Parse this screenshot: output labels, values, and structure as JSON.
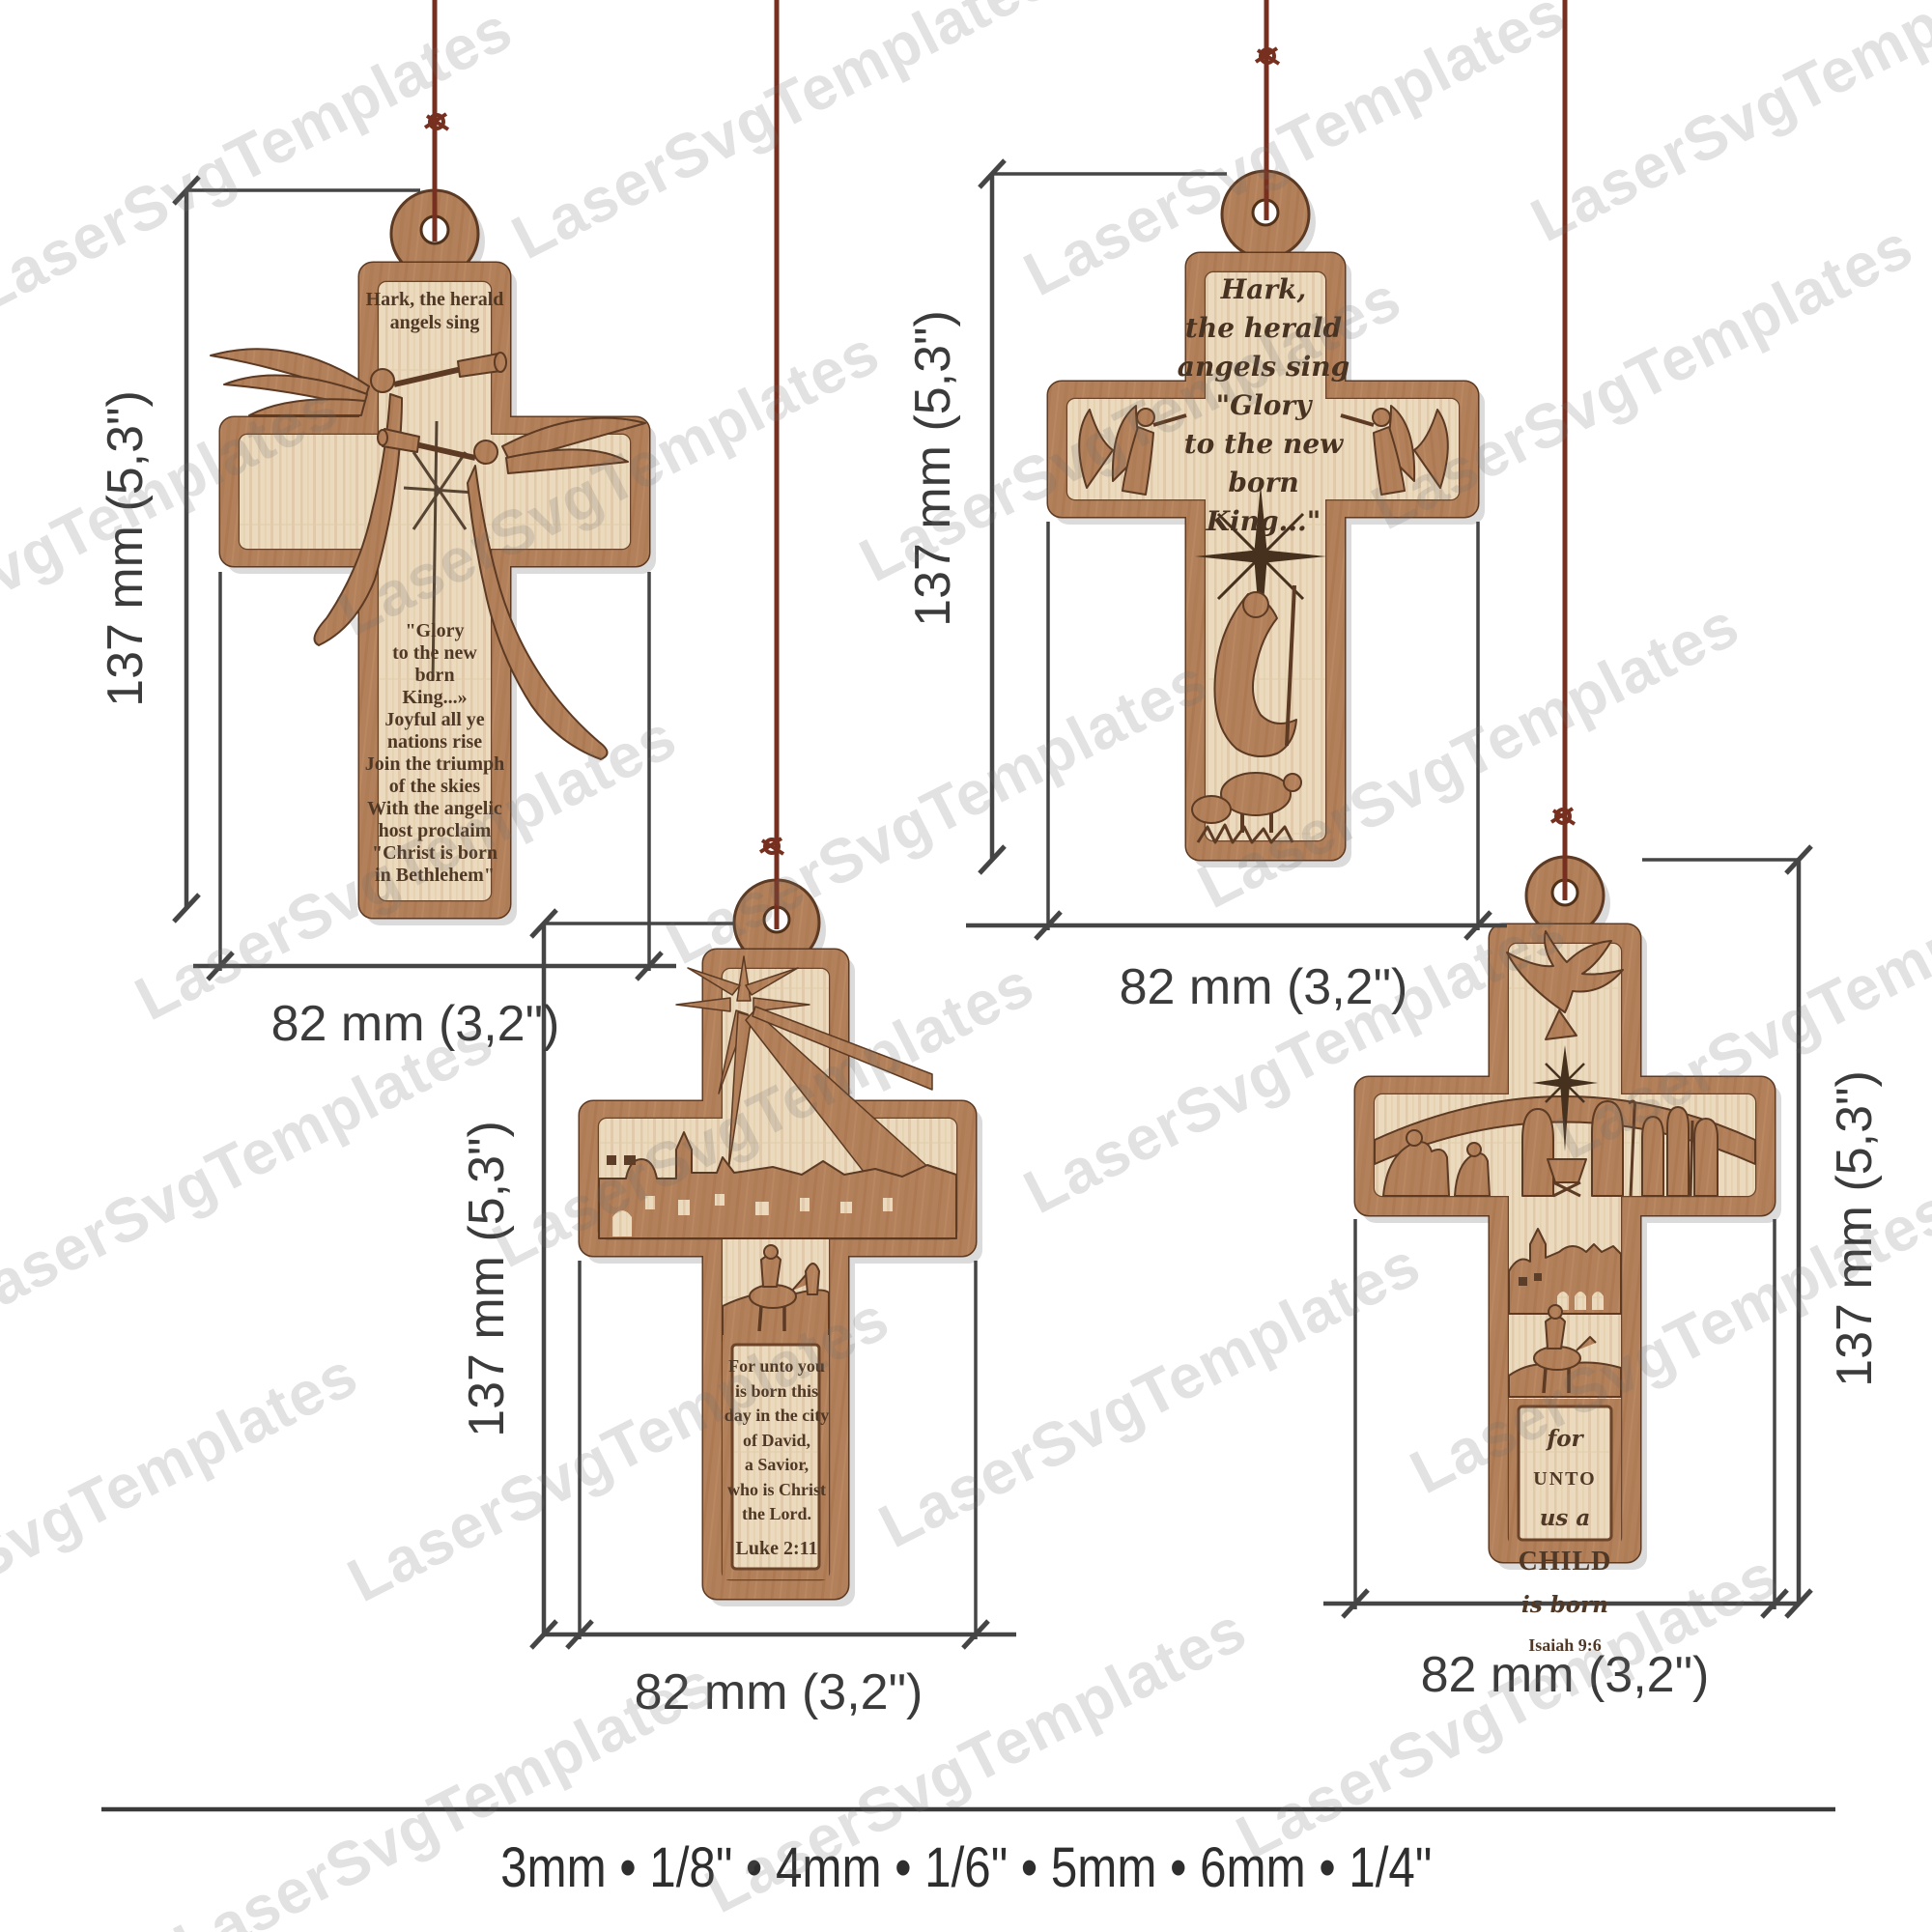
{
  "watermark": {
    "text": "LaserSvgTemplates"
  },
  "dimension_labels": {
    "height": "137 mm (5,3\")",
    "width": "82 mm (3,2\")"
  },
  "footer": {
    "thickness_options": "3mm • 1/8\" • 4mm • 1/6\" • 5mm • 6mm • 1/4\""
  },
  "crosses": {
    "angels_cross": {
      "top_text": "Hark, the herald\nangels sing",
      "verse": "\"Glory\nto the new\nborn\nKing...»\nJoyful all ye\nnations rise\nJoin the triumph\nof the skies\nWith the angelic\nhost proclaim\n\"Christ is born\nin Bethlehem\""
    },
    "glory_cross": {
      "verse": "Hark,\nthe herald\nangels sing\n\"Glory\nto the new\nborn King...\""
    },
    "luke_cross": {
      "verse": "For unto you\nis born this\nday in the city\nof David,\na Savior,\nwho is Christ\nthe Lord.",
      "reference": "Luke 2:11"
    },
    "isaiah_cross": {
      "words": [
        "for",
        "UNTO",
        "us a",
        "CHILD",
        "is born"
      ],
      "reference": "Isaiah 9:6"
    }
  }
}
